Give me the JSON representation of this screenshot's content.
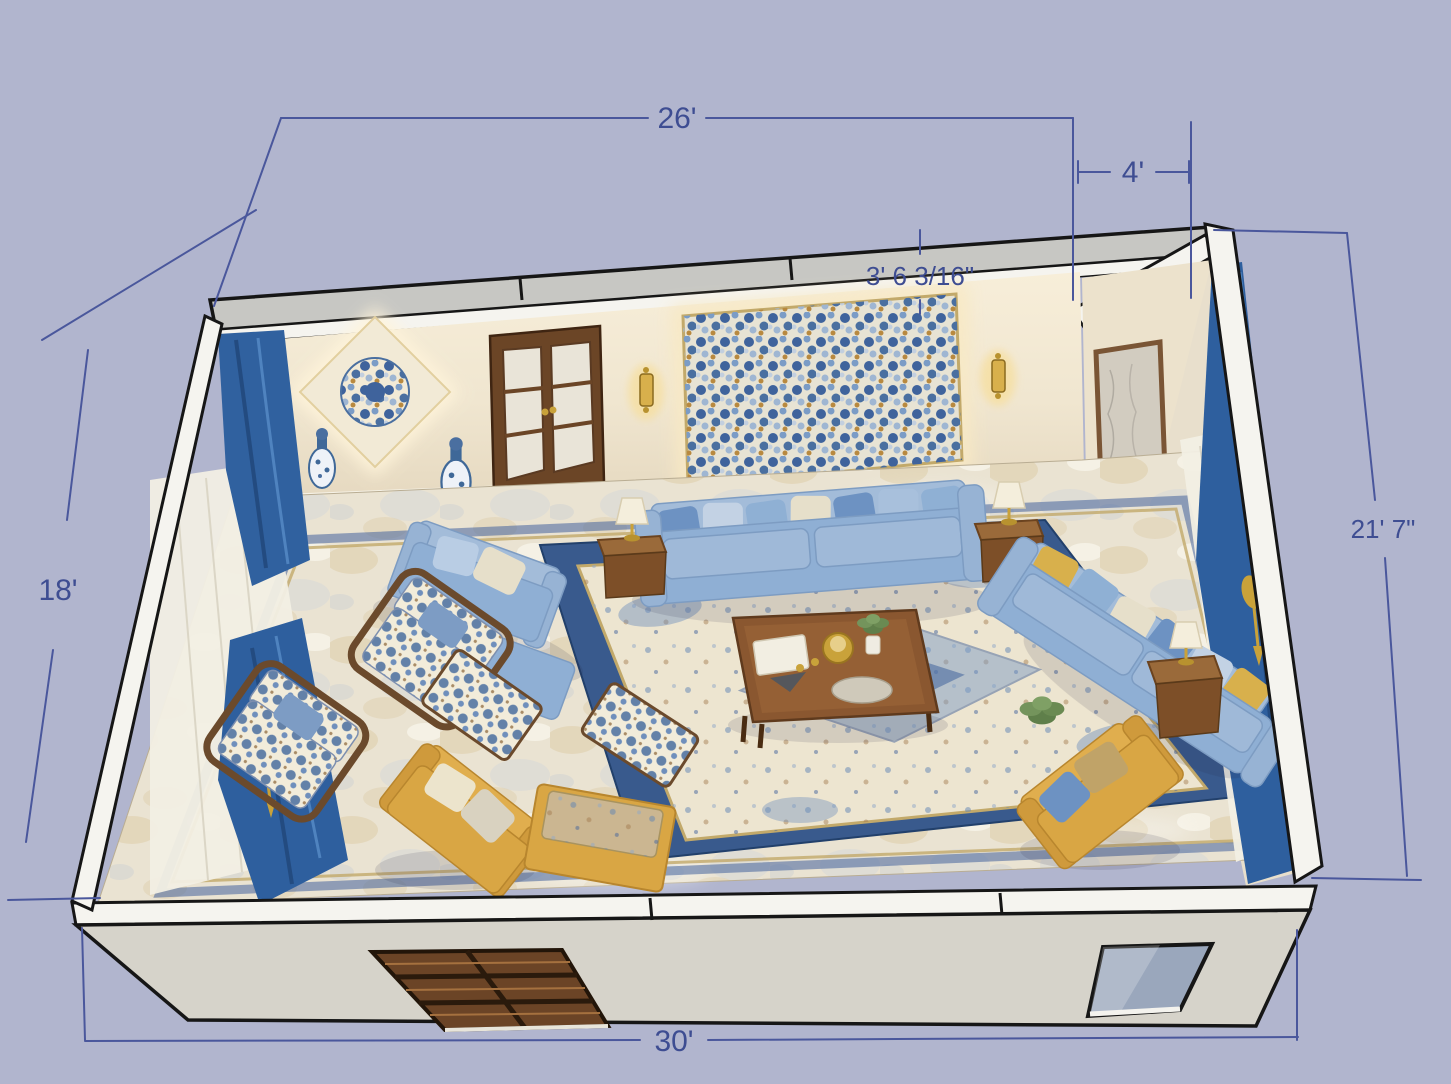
{
  "view": {
    "type": "3d-floor-plan-render",
    "room": "living-room"
  },
  "dimensions": {
    "top_width": {
      "label": "26'"
    },
    "niche_width": {
      "label": "4'"
    },
    "niche_depth": {
      "label": "3' 6 3/16\""
    },
    "right_depth": {
      "label": "21' 7\""
    },
    "left_depth": {
      "label": "18'"
    },
    "front_width": {
      "label": "30'"
    }
  },
  "palette": {
    "background": "#b1b5ce",
    "dimension_lines": "#4a579c",
    "dimension_text": "#3e4d92",
    "wall_white": "#f5f4ef",
    "wall_top_gray": "#c7c7c3",
    "interior_wall_cream": "#f0e8d6",
    "curtain_blue": "#2e5f9e",
    "sofa_blue": "#8fafd4",
    "accent_mustard": "#d9a644",
    "wood_brown": "#8a5730",
    "marble_floor": "#eae3d2",
    "rug_border_blue": "#395a8d",
    "rug_field_cream": "#ede5d0"
  },
  "objects": [
    "main-sofa",
    "right-sofa",
    "lounge-chair-with-ottoman",
    "floral-armchair-1",
    "floral-armchair-2",
    "floral-ottoman",
    "floral-bench",
    "yellow-armchair-left",
    "yellow-armchair-right",
    "yellow-ottoman",
    "coffee-table",
    "side-table-left",
    "side-table-right",
    "side-table-mid",
    "table-lamp-left",
    "table-lamp-right",
    "table-lamp-mid",
    "area-rug",
    "marble-floor",
    "tile-border",
    "left-curtains",
    "right-curtains",
    "double-door",
    "right-door",
    "mosaic-wall-panel",
    "medallion-wall-art",
    "wall-sconce-left",
    "wall-sconce-right",
    "porcelain-vases",
    "shuttered-window",
    "front-window"
  ]
}
